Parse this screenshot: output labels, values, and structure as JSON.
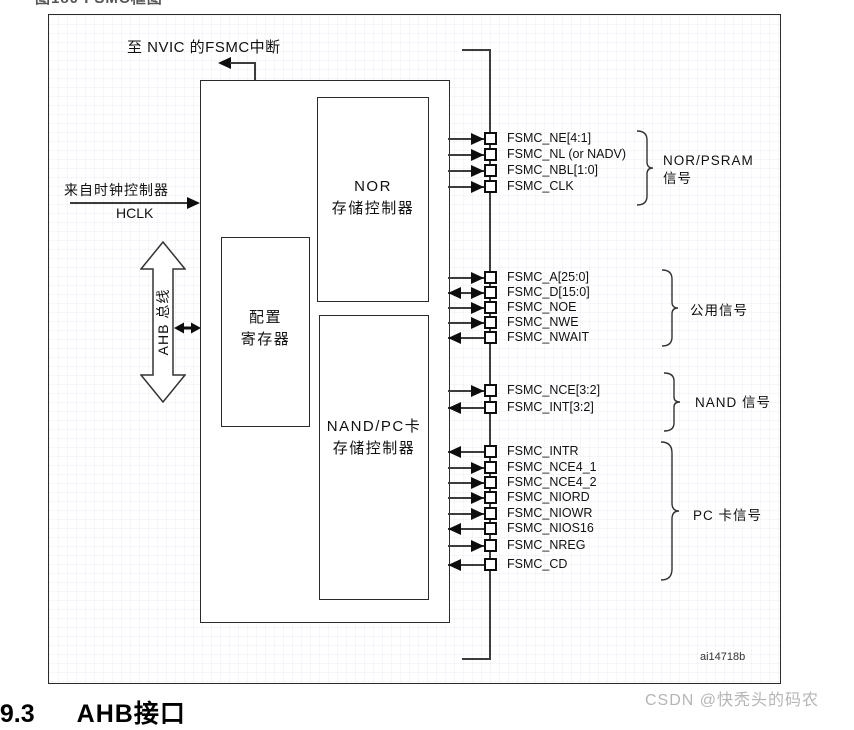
{
  "page": {
    "top_caption": "图180 FSMC框图",
    "figure_code": "ai14718b",
    "watermark": "CSDN @快秃头的码农",
    "bottom_heading": {
      "number": "19.3",
      "title": "AHB接口"
    }
  },
  "diagram": {
    "nvic_interrupt_label": "至 NVIC 的FSMC中断",
    "clock_source_label": "来自时钟控制器",
    "clock_signal_label": "HCLK",
    "ahb_bus_label": "AHB 总线",
    "blocks": {
      "config_line1": "配置",
      "config_line2": "寄存器",
      "nor_line1": "NOR",
      "nor_line2": "存储控制器",
      "nand_line1": "NAND/PC卡",
      "nand_line2": "存储控制器"
    },
    "signal_groups": [
      {
        "label_line1": "NOR/PSRAM",
        "label_line2": "信号",
        "signals": [
          {
            "name": "FSMC_NE[4:1]",
            "dir": "out"
          },
          {
            "name": "FSMC_NL (or NADV)",
            "dir": "out"
          },
          {
            "name": "FSMC_NBL[1:0]",
            "dir": "out"
          },
          {
            "name": "FSMC_CLK",
            "dir": "out"
          }
        ]
      },
      {
        "label_line1": "公用信号",
        "label_line2": "",
        "signals": [
          {
            "name": "FSMC_A[25:0]",
            "dir": "out"
          },
          {
            "name": "FSMC_D[15:0]",
            "dir": "bidir"
          },
          {
            "name": "FSMC_NOE",
            "dir": "out"
          },
          {
            "name": "FSMC_NWE",
            "dir": "out"
          },
          {
            "name": "FSMC_NWAIT",
            "dir": "in"
          }
        ]
      },
      {
        "label_line1": "NAND 信号",
        "label_line2": "",
        "signals": [
          {
            "name": "FSMC_NCE[3:2]",
            "dir": "out"
          },
          {
            "name": "FSMC_INT[3:2]",
            "dir": "in"
          }
        ]
      },
      {
        "label_line1": "PC 卡信号",
        "label_line2": "",
        "signals": [
          {
            "name": "FSMC_INTR",
            "dir": "in"
          },
          {
            "name": "FSMC_NCE4_1",
            "dir": "out"
          },
          {
            "name": "FSMC_NCE4_2",
            "dir": "out"
          },
          {
            "name": "FSMC_NIORD",
            "dir": "out"
          },
          {
            "name": "FSMC_NIOWR",
            "dir": "out"
          },
          {
            "name": "FSMC_NIOS16",
            "dir": "in"
          },
          {
            "name": "FSMC_NREG",
            "dir": "out"
          },
          {
            "name": "FSMC_CD",
            "dir": "in"
          }
        ]
      }
    ]
  },
  "colors": {
    "line": "#3c3c3c",
    "text": "#111111",
    "watermark": "#b5b5b5"
  }
}
